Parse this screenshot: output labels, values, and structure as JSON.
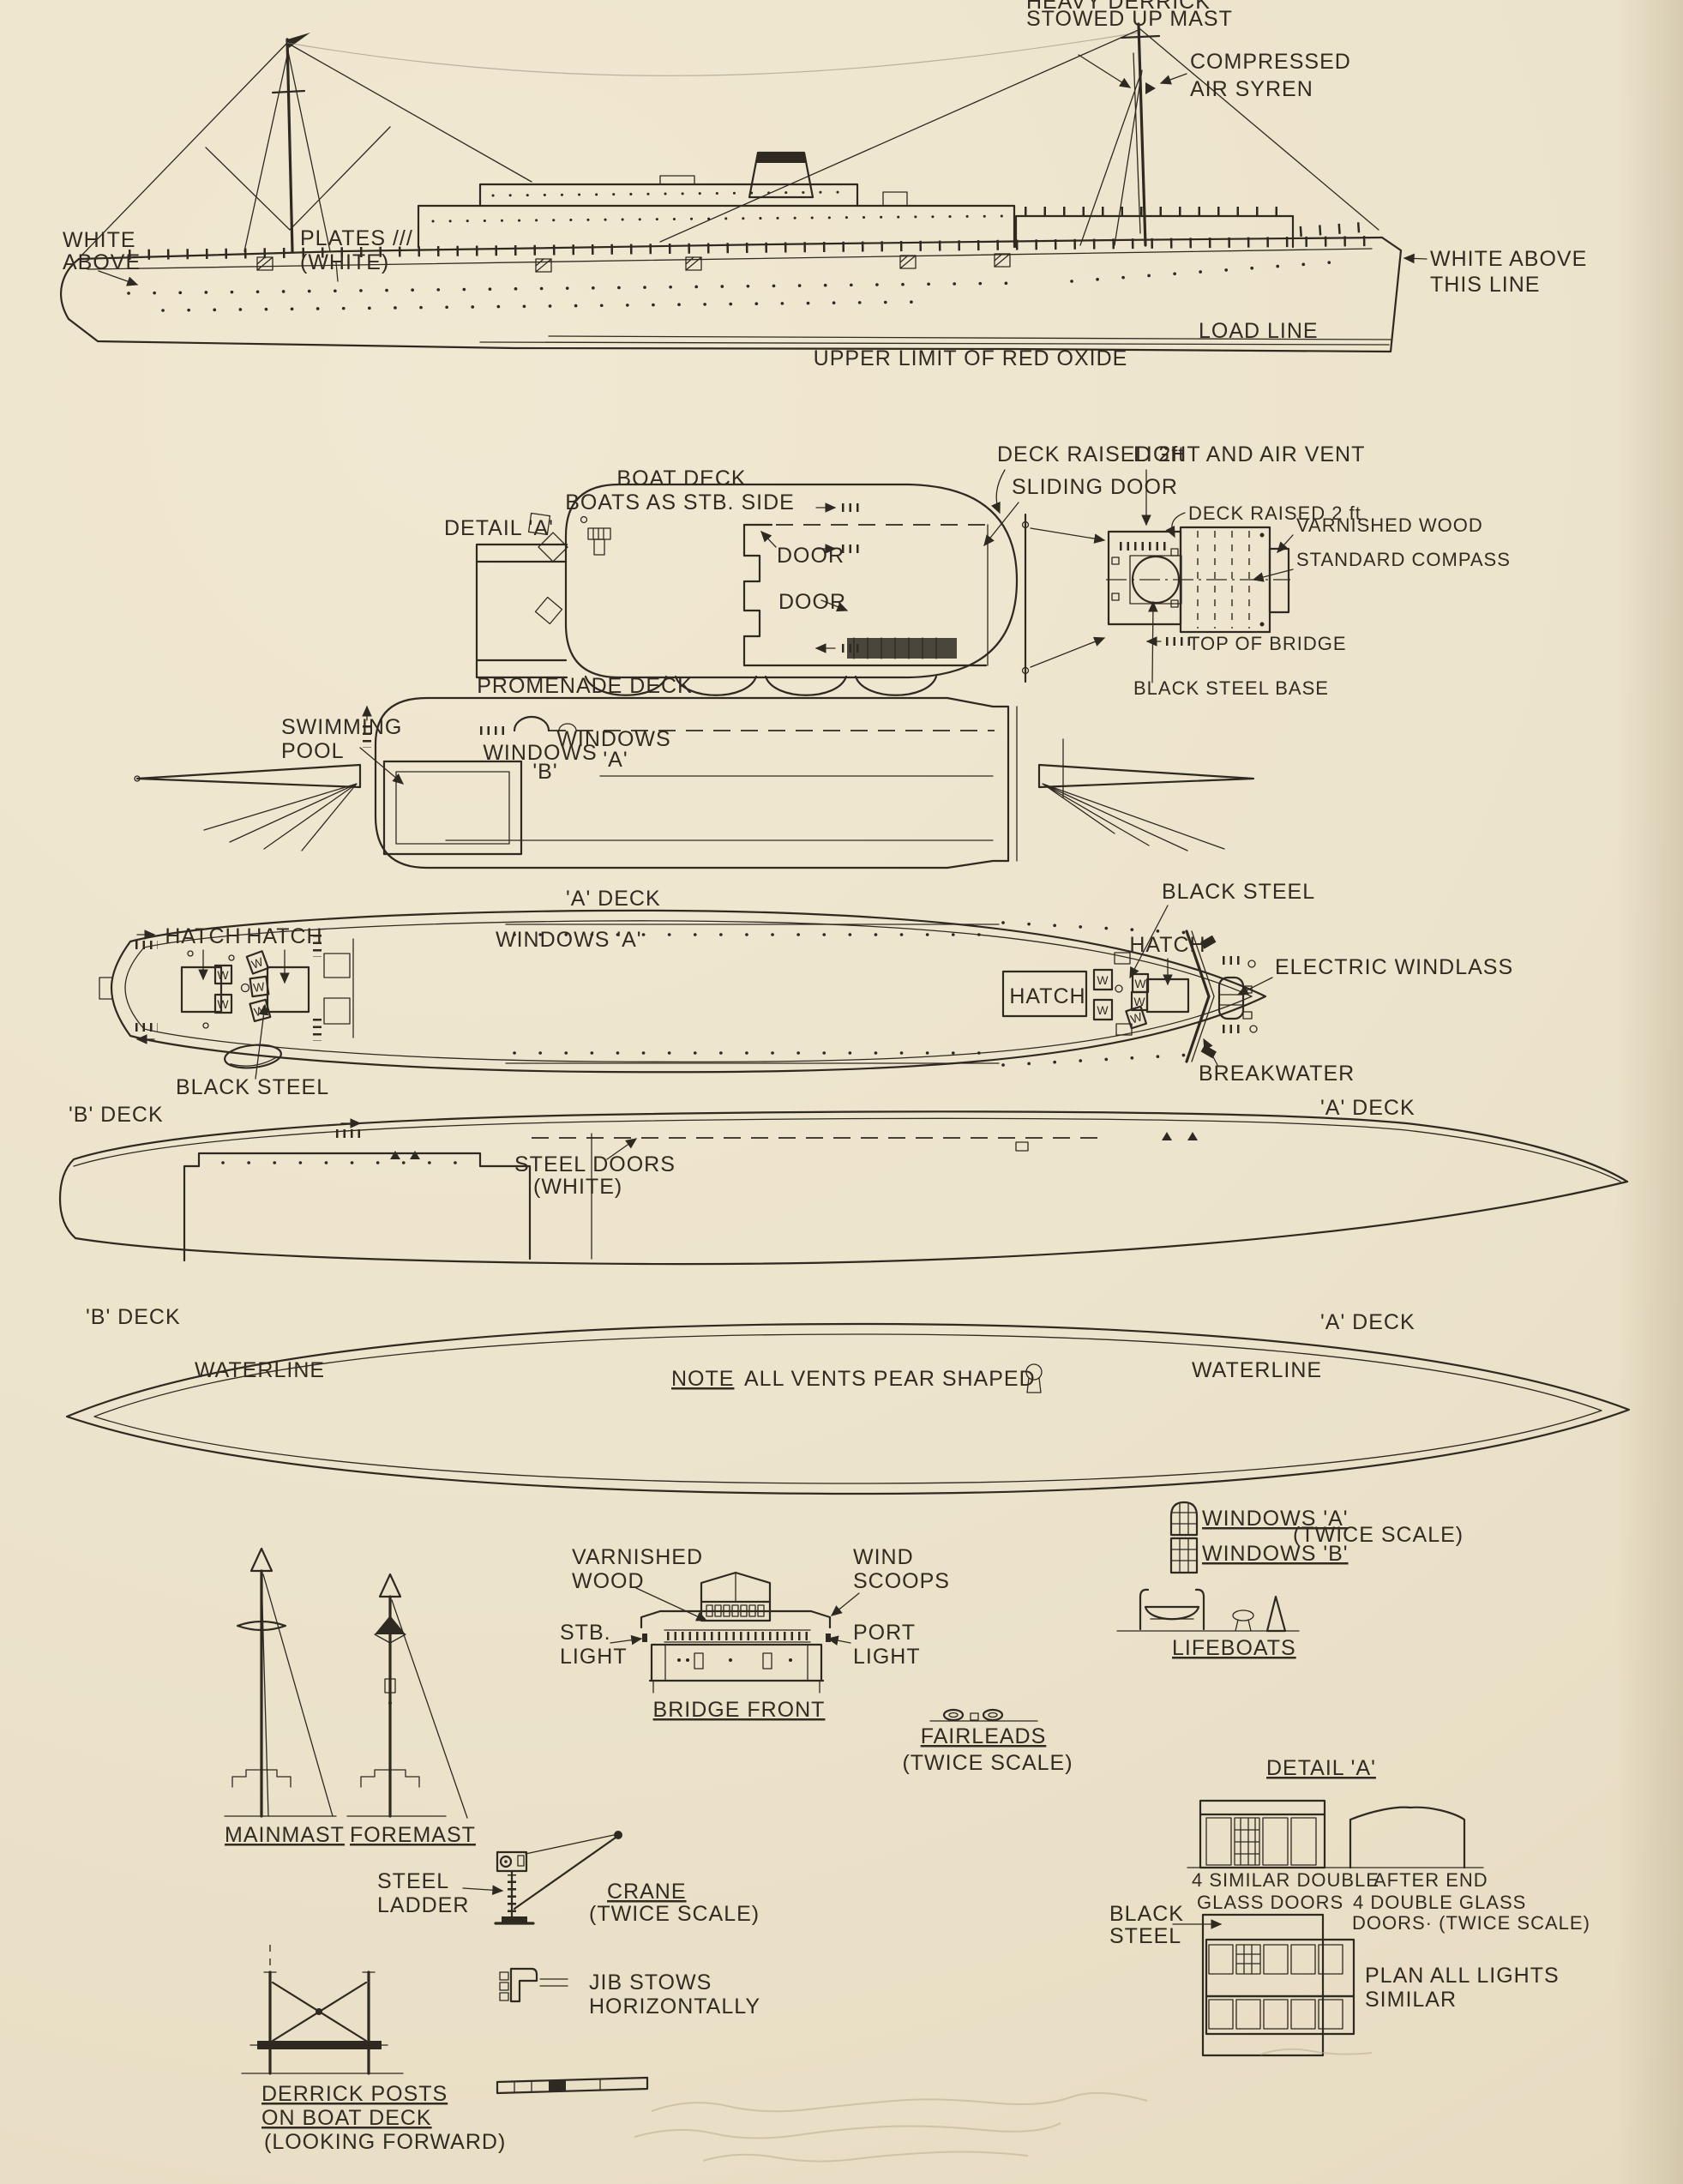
{
  "page": {
    "background": "#ece3cb",
    "ink": "#2e2921",
    "pencil": "#b3a78c"
  },
  "side": {
    "heavy_derrick_l1": "HEAVY DERRICK",
    "heavy_derrick_l2": "STOWED UP MAST",
    "compressed_l1": "COMPRESSED",
    "compressed_l2": "AIR SYREN",
    "white_above_l1": "WHITE",
    "white_above_l2": "ABOVE",
    "plates_l1": "PLATES ///",
    "plates_l2": "(WHITE)",
    "white_above_line_l1": "WHITE ABOVE",
    "white_above_line_l2": "THIS LINE",
    "load_line": "LOAD LINE",
    "red_oxide": "UPPER LIMIT OF RED OXIDE"
  },
  "boat_deck": {
    "title_l1": "BOAT DECK",
    "title_l2": "BOATS AS STB. SIDE",
    "detail_a": "DETAIL 'A'",
    "deck_raised": "DECK RAISED 2ft",
    "sliding_door": "SLIDING DOOR",
    "door_1": "DOOR",
    "door_2": "DOOR",
    "light_air_vent": "LIGHT AND AIR VENT",
    "deck_raised_2": "DECK RAISED 2 ft",
    "varnished_wood": "VARNISHED WOOD",
    "standard_compass": "STANDARD COMPASS",
    "top_of_bridge": "TOP OF BRIDGE",
    "black_steel_base": "BLACK STEEL BASE"
  },
  "promenade": {
    "title": "PROMENADE DECK",
    "swimming_l1": "SWIMMING",
    "swimming_l2": "POOL",
    "windows_b_l1": "WINDOWS",
    "windows_b_l2": "'B'",
    "windows_a_l1": "WINDOWS",
    "windows_a_l2": "'A'"
  },
  "a_deck": {
    "title": "'A' DECK",
    "hatch_1": "HATCH",
    "hatch_2": "HATCH",
    "windows_a": "WINDOWS 'A'",
    "black_steel_left": "BLACK STEEL",
    "black_steel_right": "BLACK STEEL",
    "hatch_3": "HATCH",
    "hatch_4": "HATCH",
    "electric_windlass": "ELECTRIC WINDLASS",
    "breakwater": "BREAKWATER",
    "winch_letter": "W"
  },
  "b_deck": {
    "title": "'B' DECK",
    "steel_doors_l1": "STEEL DOORS",
    "steel_doors_l2": "(WHITE)",
    "a_deck_right": "'A' DECK"
  },
  "waterline": {
    "b_deck": "'B' DECK",
    "waterline_left": "WATERLINE",
    "note_word": "NOTE",
    "note_rest": "ALL VENTS PEAR SHAPED",
    "waterline_right": "WATERLINE",
    "a_deck": "'A' DECK"
  },
  "details": {
    "windows_a": "WINDOWS 'A'",
    "windows_b": "WINDOWS 'B'",
    "twice_scale_windows": "(TWICE SCALE)",
    "lifeboats": "LIFEBOATS",
    "varnished_l1": "VARNISHED",
    "varnished_l2": "WOOD",
    "wind_l1": "WIND",
    "wind_l2": "SCOOPS",
    "stb_l1": "STB.",
    "stb_l2": "LIGHT",
    "port_l1": "PORT",
    "port_l2": "LIGHT",
    "bridge_front": "BRIDGE FRONT",
    "fairleads": "FAIRLEADS",
    "twice_scale_fairleads": "(TWICE SCALE)",
    "mainmast": "MAINMAST",
    "foremast": "FOREMAST",
    "steel_l1": "STEEL",
    "steel_l2": "LADDER",
    "crane": "CRANE",
    "twice_scale_crane": "(TWICE SCALE)",
    "jib_l1": "JIB STOWS",
    "jib_l2": "HORIZONTALLY",
    "detail_a": "DETAIL 'A'",
    "doors_left_l1": "4 SIMILAR DOUBLE",
    "doors_left_l2": "GLASS DOORS",
    "doors_right_l1": "AFTER END",
    "doors_right_l2": "4 DOUBLE GLASS",
    "doors_right_l3": "DOORS· (TWICE SCALE)",
    "black_steel_l1": "BLACK",
    "black_steel_l2": "STEEL",
    "plan_lights_l1": "PLAN ALL LIGHTS",
    "plan_lights_l2": "SIMILAR",
    "derrick_l1": "DERRICK POSTS",
    "derrick_l2": "ON BOAT DECK",
    "derrick_l3": "(LOOKING FORWARD)"
  }
}
